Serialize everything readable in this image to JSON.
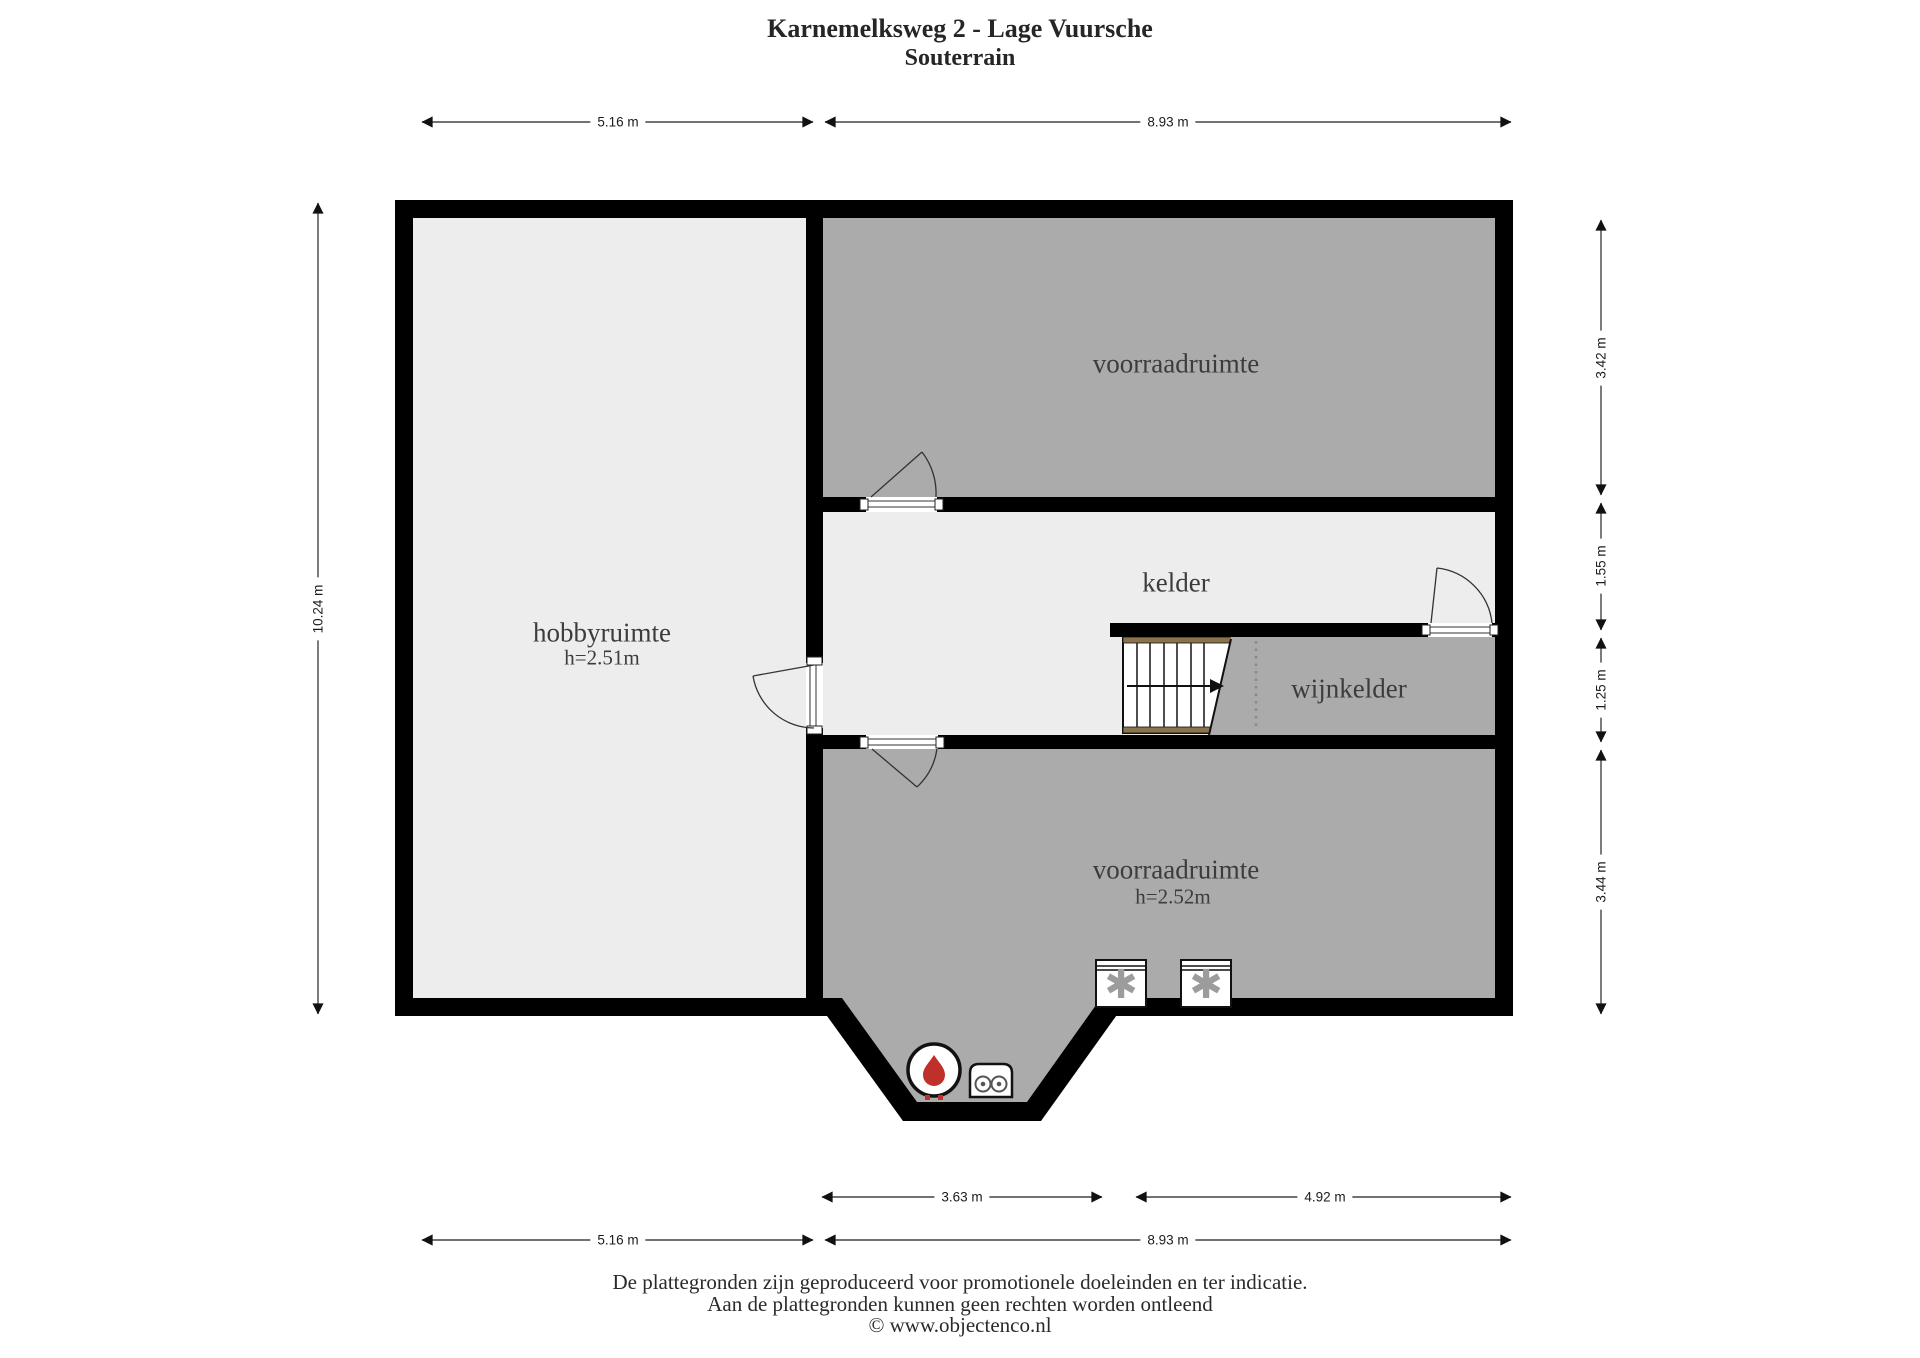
{
  "title": {
    "address": "Karnemelksweg 2 - Lage Vuursche",
    "floor": "Souterrain"
  },
  "rooms": {
    "voorraadruimte_top": {
      "label": "voorraadruimte"
    },
    "hobbyruimte": {
      "label": "hobbyruimte",
      "height": "h=2.51m"
    },
    "kelder": {
      "label": "kelder"
    },
    "wijnkelder": {
      "label": "wijnkelder"
    },
    "voorraadruimte_bottom": {
      "label": "voorraadruimte",
      "height": "h=2.52m"
    }
  },
  "dimensions": {
    "top_left": "5.16 m",
    "top_right": "8.93 m",
    "left": "10.24 m",
    "right_1": "3.42 m",
    "right_2": "1.55 m",
    "right_3": "1.25 m",
    "right_4": "3.44 m",
    "bottom_inner_left": "3.63 m",
    "bottom_inner_right": "4.92 m",
    "bottom_outer_left": "5.16 m",
    "bottom_outer_right": "8.93 m"
  },
  "icons": {
    "appliance_symbol": "✱"
  },
  "colors": {
    "wall": "#000000",
    "room_dark": "#ababab",
    "room_light": "#ededed",
    "stair_rail": "#8b734b",
    "flame_red": "#c0302b"
  },
  "footer": {
    "line1": "De plattegronden zijn geproduceerd voor promotionele doeleinden en ter indicatie.",
    "line2": "Aan de plattegronden kunnen geen rechten worden ontleend",
    "line3": "© www.objectenco.nl"
  }
}
